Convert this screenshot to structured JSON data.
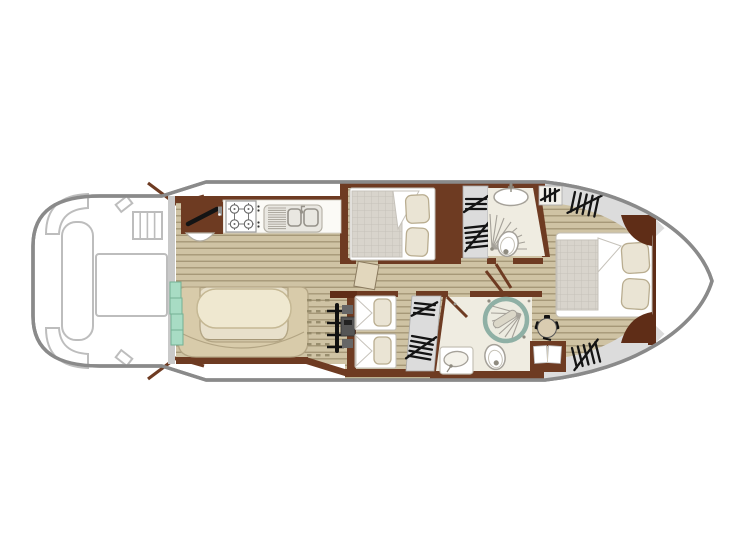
{
  "document": {
    "title": "Canal boat deck plan - top view",
    "type": "vessel-floor-plan",
    "background": "#ffffff"
  },
  "colors": {
    "hull_outline": "#8a8a8a",
    "deck_outline": "#bdbdbd",
    "bulkhead_gray": "#c9c9c9",
    "wall_brown": "#6e3b22",
    "wall_brown_dark": "#5f2d17",
    "wood_floor": "#cfc3a4",
    "wood_stripe": "#a69878",
    "bench": "#d8cbaa",
    "bench_border": "#b3a584",
    "table": "#efe8d0",
    "table_border": "#c5b894",
    "footwell": "#e8e0cb",
    "mattress": "#d8d4cc",
    "mattress_grid": "#c6c2ba",
    "pillow": "#eae4d4",
    "pillow_border": "#b9ad90",
    "bath_floor": "#efece1",
    "fixture": "#a5a199",
    "locker_gray": "#dcdcdc",
    "hatch": "#141414",
    "steps_green": "#a8dcc4",
    "steps_green_border": "#74b194",
    "shower_ring": "#8fb0a5",
    "door_leaf": "#e2d7bd",
    "counter": "#fbfaf6",
    "canvas": "#ffffff"
  },
  "features": [
    {
      "id": "aft-deck",
      "name": "Aft cockpit deck with corner seats, side bench, deck table and boarding steps"
    },
    {
      "id": "galley",
      "name": "Galley with 4-burner hob, twin sink with drainer, and counter"
    },
    {
      "id": "dinette",
      "name": "U-shaped dinette bench with oval table"
    },
    {
      "id": "entry-steps",
      "name": "Companionway steps"
    },
    {
      "id": "helm-station",
      "name": "Inside steering station with wheel and instruments"
    },
    {
      "id": "cabin-double",
      "name": "Guest cabin with double bed"
    },
    {
      "id": "cabin-twin",
      "name": "Guest cabin with two single beds"
    },
    {
      "id": "bathroom-mid",
      "name": "Bathroom with corner shower, toilet and washbasin"
    },
    {
      "id": "bathroom-aft",
      "name": "Bathroom with round shower cabin, toilet and washbasin"
    },
    {
      "id": "master-cabin",
      "name": "Bow master cabin with double bed, desk, chair and wardrobes"
    },
    {
      "id": "wardrobe-symbols",
      "name": "Hanging locker (wardrobe) hatch symbols"
    }
  ]
}
